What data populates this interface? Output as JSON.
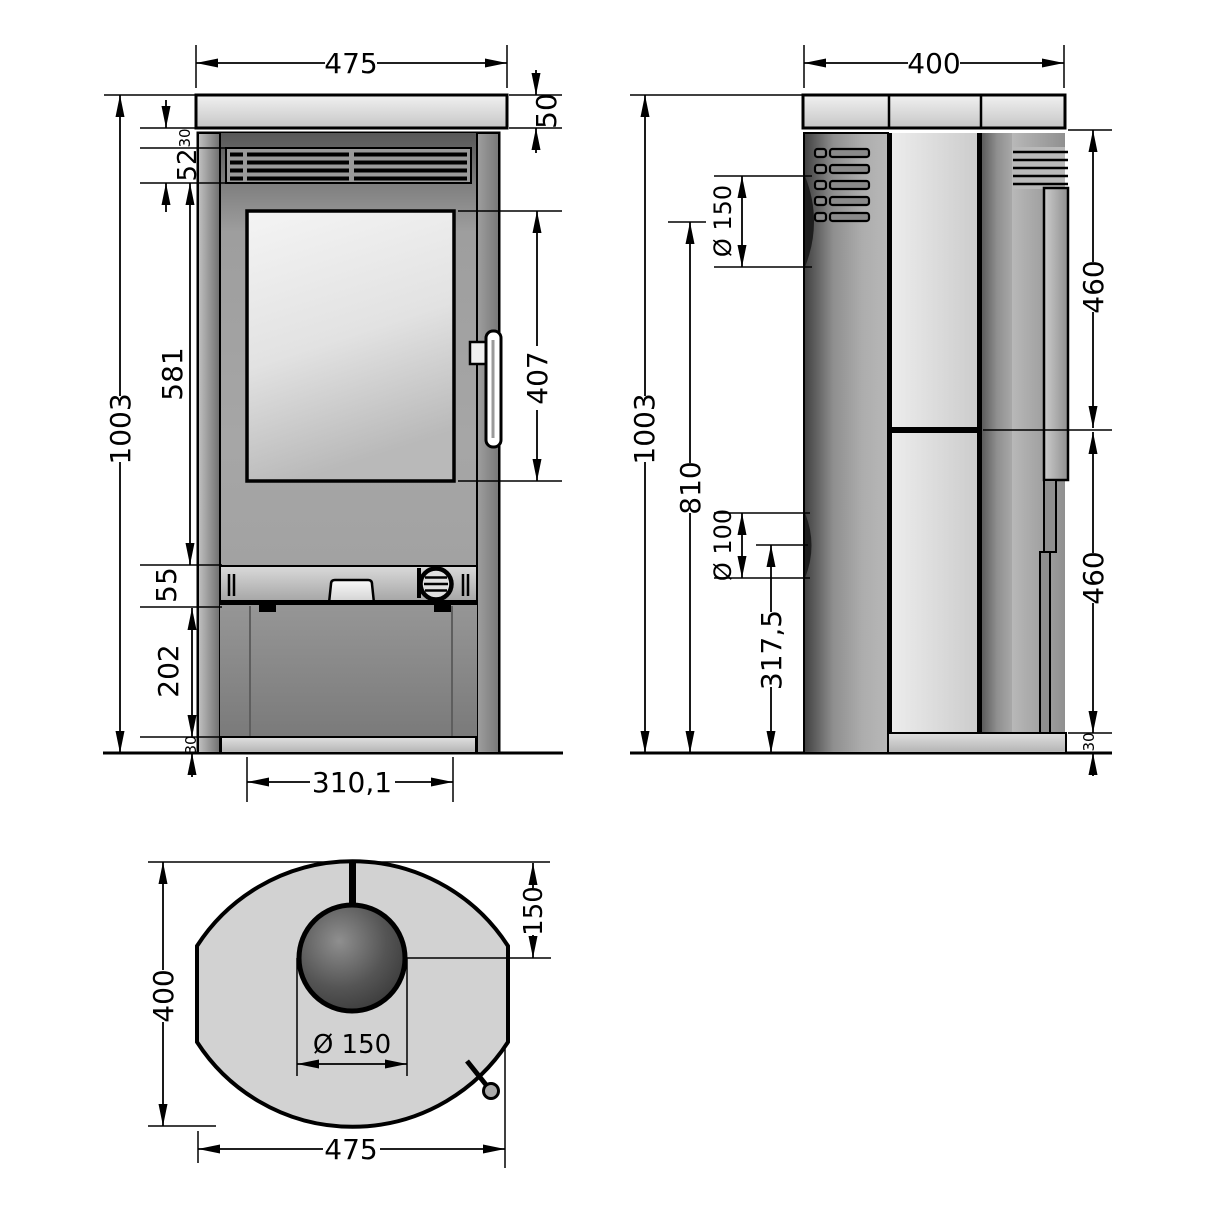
{
  "palette": {
    "line": "#000000",
    "panel_light": "#d2d2d2",
    "panel_dark": "#4f4f4f",
    "glass": "#e8e8e8"
  },
  "dims": {
    "front": {
      "width": "475",
      "top_plate": "50",
      "top_gap": "30",
      "vent": "52",
      "upper_body": "581",
      "height": "1003",
      "control": "55",
      "lower_panel": "202",
      "plinth": "30",
      "glass": "407",
      "door_width": "310,1"
    },
    "side": {
      "depth": "400",
      "flue": "Ø 150",
      "height": "1003",
      "flue_axis": "810",
      "outlet": "Ø 100",
      "outlet_axis": "317,5",
      "upper": "460",
      "lower": "460",
      "plinth": "30"
    },
    "top": {
      "height": "400",
      "flue_offset": "150",
      "flue": "Ø 150",
      "width": "475"
    }
  }
}
